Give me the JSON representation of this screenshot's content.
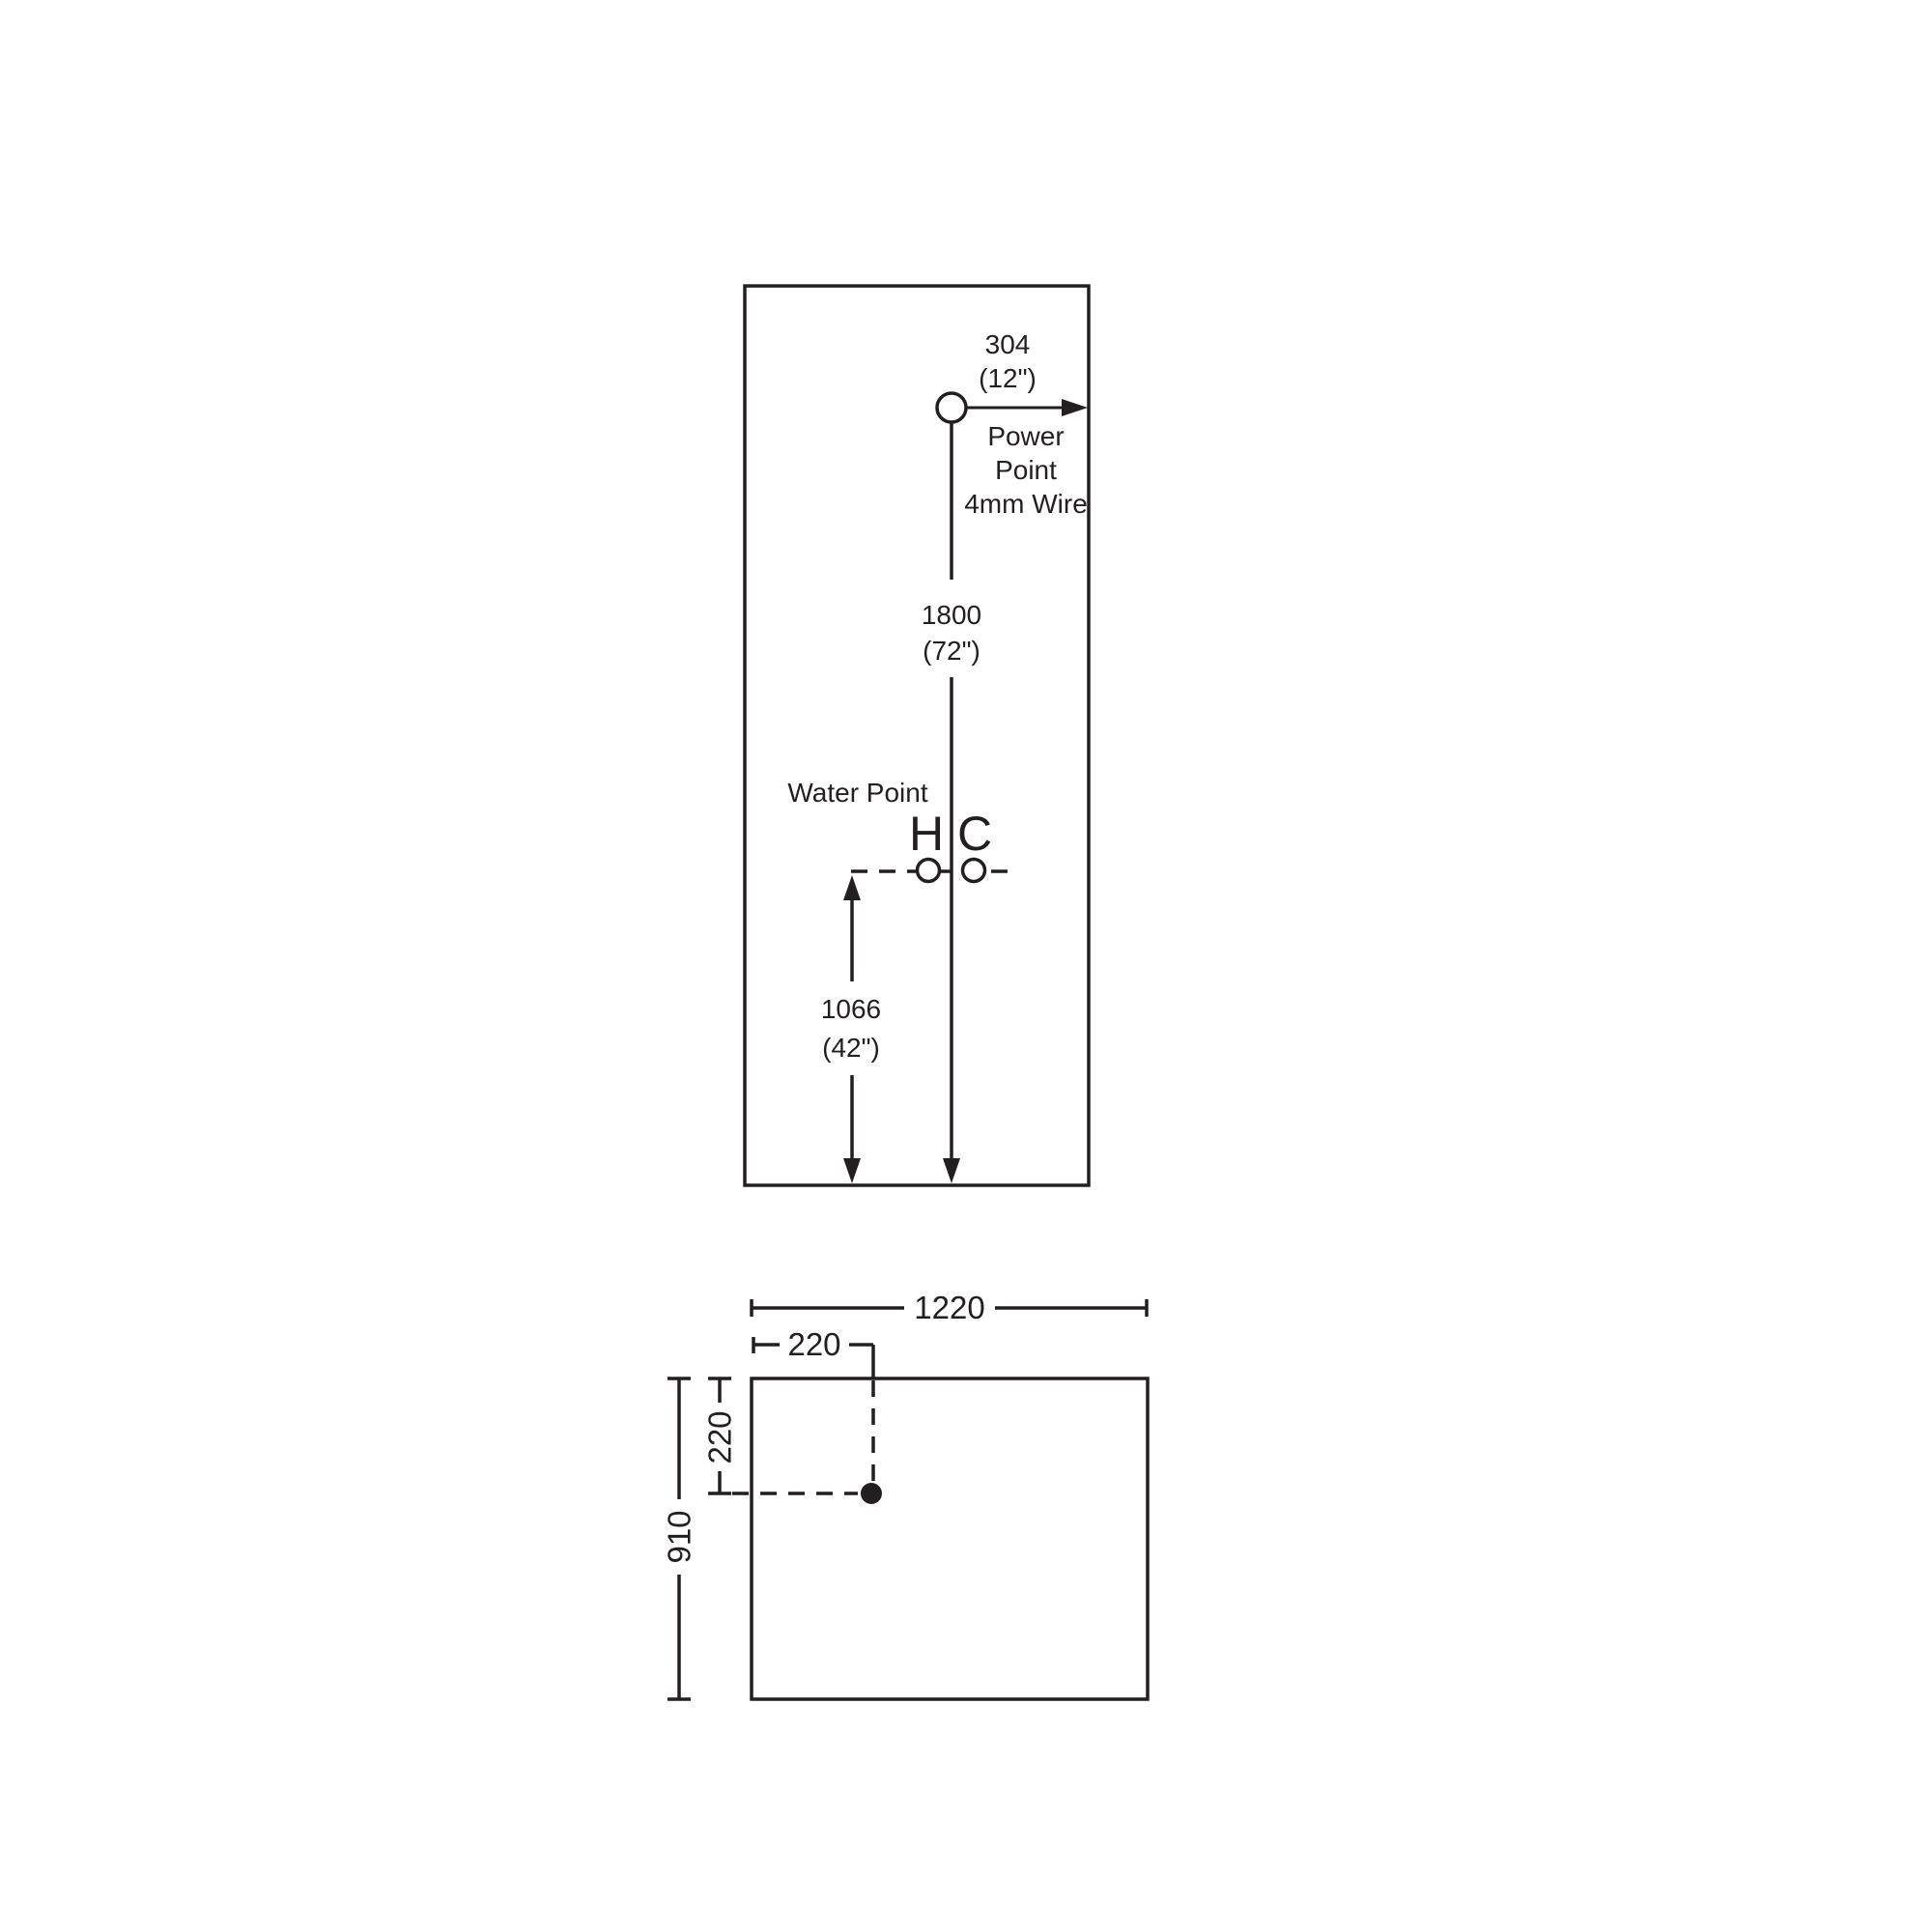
{
  "drawing": {
    "type": "installation-dimension-diagram",
    "background_color": "#ffffff",
    "line_color": "#231f20",
    "elevation": {
      "power_point_offset": {
        "mm": "304",
        "inches": "(12\")"
      },
      "power_point_label": [
        "Power",
        "Point",
        "4mm Wire"
      ],
      "power_point_height": {
        "mm": "1800",
        "inches": "(72\")"
      },
      "water_point_label": "Water Point",
      "hot_tap_label": "H",
      "cold_tap_label": "C",
      "water_point_height": {
        "mm": "1066",
        "inches": "(42\")"
      }
    },
    "plan": {
      "overall_width": "1220",
      "inlet_offset_from_left": "220",
      "inlet_offset_from_top": "220",
      "overall_depth": "910"
    }
  }
}
